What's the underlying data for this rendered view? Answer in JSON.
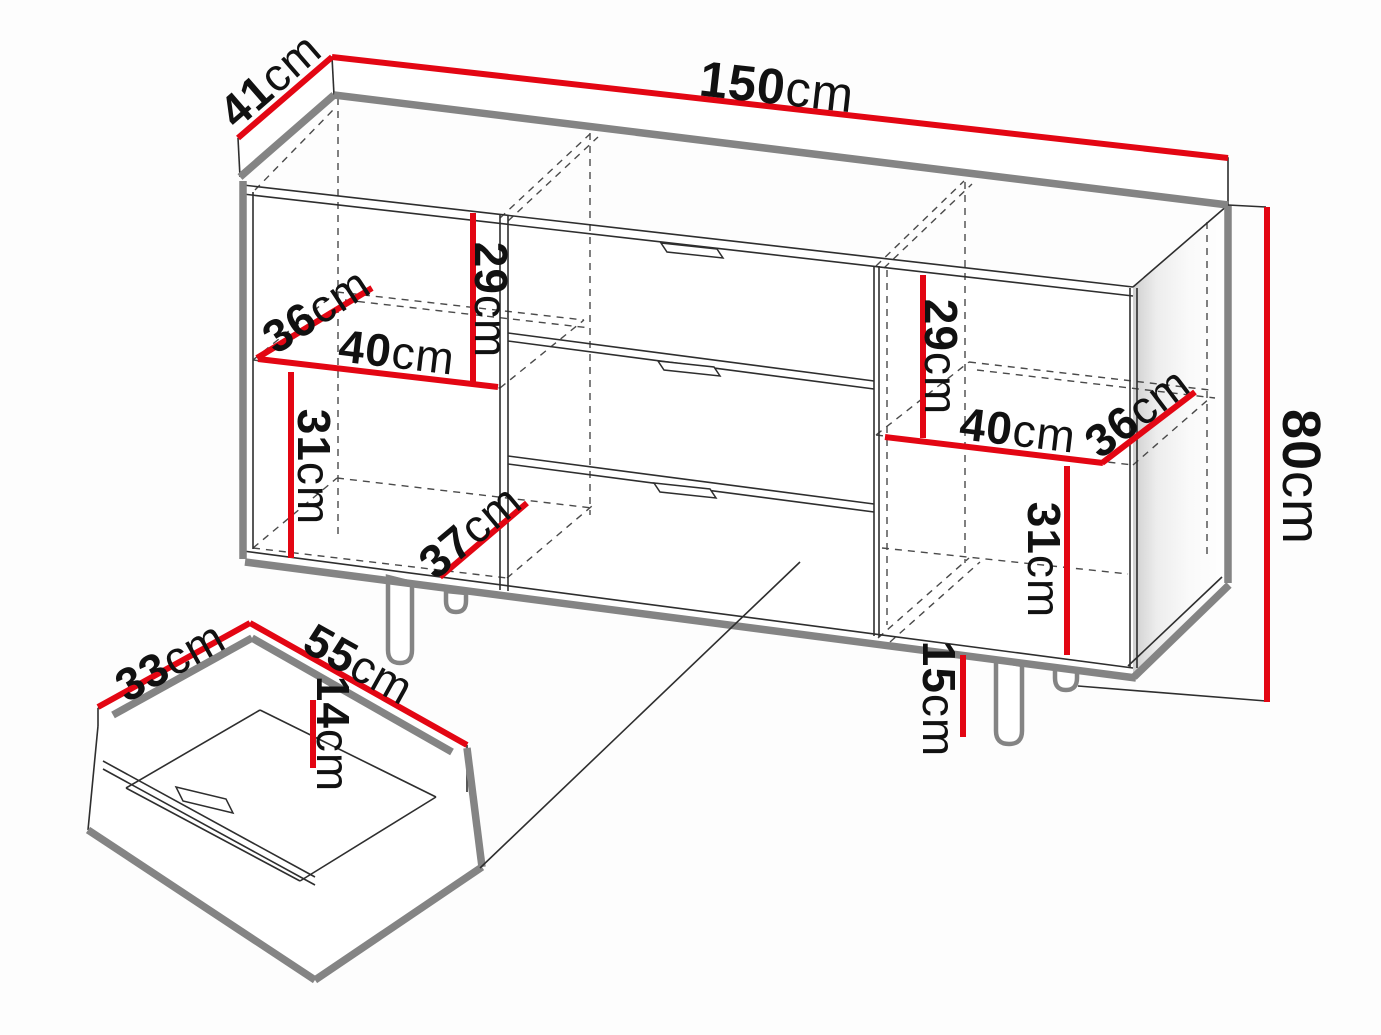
{
  "diagram": {
    "dimension_unit": "cm",
    "colors": {
      "dimension_line": "#e30613",
      "edge_dark": "#2e2e2e",
      "edge_gray": "#848484",
      "background": "#fdfdfd"
    },
    "cabinet": {
      "dimensions": {
        "width": {
          "value": "150",
          "unit": "cm"
        },
        "depth": {
          "value": "41",
          "unit": "cm"
        },
        "height": {
          "value": "80",
          "unit": "cm"
        },
        "leg_height": {
          "value": "15",
          "unit": "cm"
        },
        "left_upper_height": {
          "value": "29",
          "unit": "cm"
        },
        "left_shelf_depth": {
          "value": "36",
          "unit": "cm"
        },
        "left_shelf_width": {
          "value": "40",
          "unit": "cm"
        },
        "left_lower_height": {
          "value": "31",
          "unit": "cm"
        },
        "left_bottom_depth": {
          "value": "37",
          "unit": "cm"
        },
        "right_upper_height": {
          "value": "29",
          "unit": "cm"
        },
        "right_shelf_width": {
          "value": "40",
          "unit": "cm"
        },
        "right_shelf_depth": {
          "value": "36",
          "unit": "cm"
        },
        "right_lower_height": {
          "value": "31",
          "unit": "cm"
        }
      }
    },
    "drawer": {
      "dimensions": {
        "depth": {
          "value": "33",
          "unit": "cm"
        },
        "width": {
          "value": "55",
          "unit": "cm"
        },
        "inner_height": {
          "value": "14",
          "unit": "cm"
        }
      }
    }
  }
}
